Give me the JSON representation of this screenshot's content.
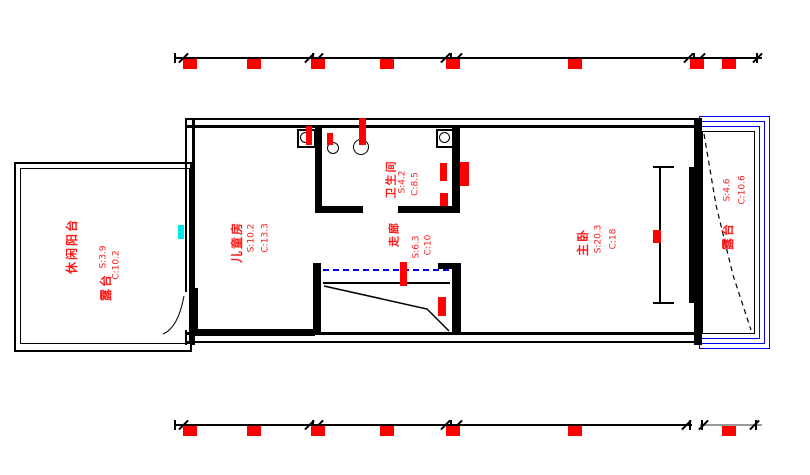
{
  "drawing": {
    "type": "residential-floor-plan",
    "rooms": [
      {
        "id": "leisure-balcony",
        "name": "休闲阳台",
        "alt_name": "露台",
        "area": "S:3.9",
        "circ": "C:10.2"
      },
      {
        "id": "children-room",
        "name": "儿童房",
        "area": "S:10.2",
        "circ": "C:13.3"
      },
      {
        "id": "bathroom",
        "name": "卫生间",
        "area": "S:4.2",
        "circ": "C:8.5"
      },
      {
        "id": "corridor",
        "name": "走廊",
        "area": "S:6.3",
        "circ": "C:10"
      },
      {
        "id": "master-bedroom",
        "name": "主卧",
        "area": "S:20.3",
        "circ": "C:18"
      },
      {
        "id": "terrace",
        "name": "露台",
        "area": "S:4.6",
        "circ": "C:10.6"
      }
    ],
    "dimensions": {
      "top_redacted_marker_count": 8,
      "bottom_redacted_marker_count": 7
    },
    "colors": {
      "wall": "#000000",
      "room_label": "#ff1a1a",
      "redacted_marker": "#fe0000",
      "window_frame_blue": "#0000ee",
      "guide_dashed_blue": "#0000ee",
      "accent_cyan": "#00e5ee",
      "secondary_dim_gray": "#999999"
    }
  }
}
